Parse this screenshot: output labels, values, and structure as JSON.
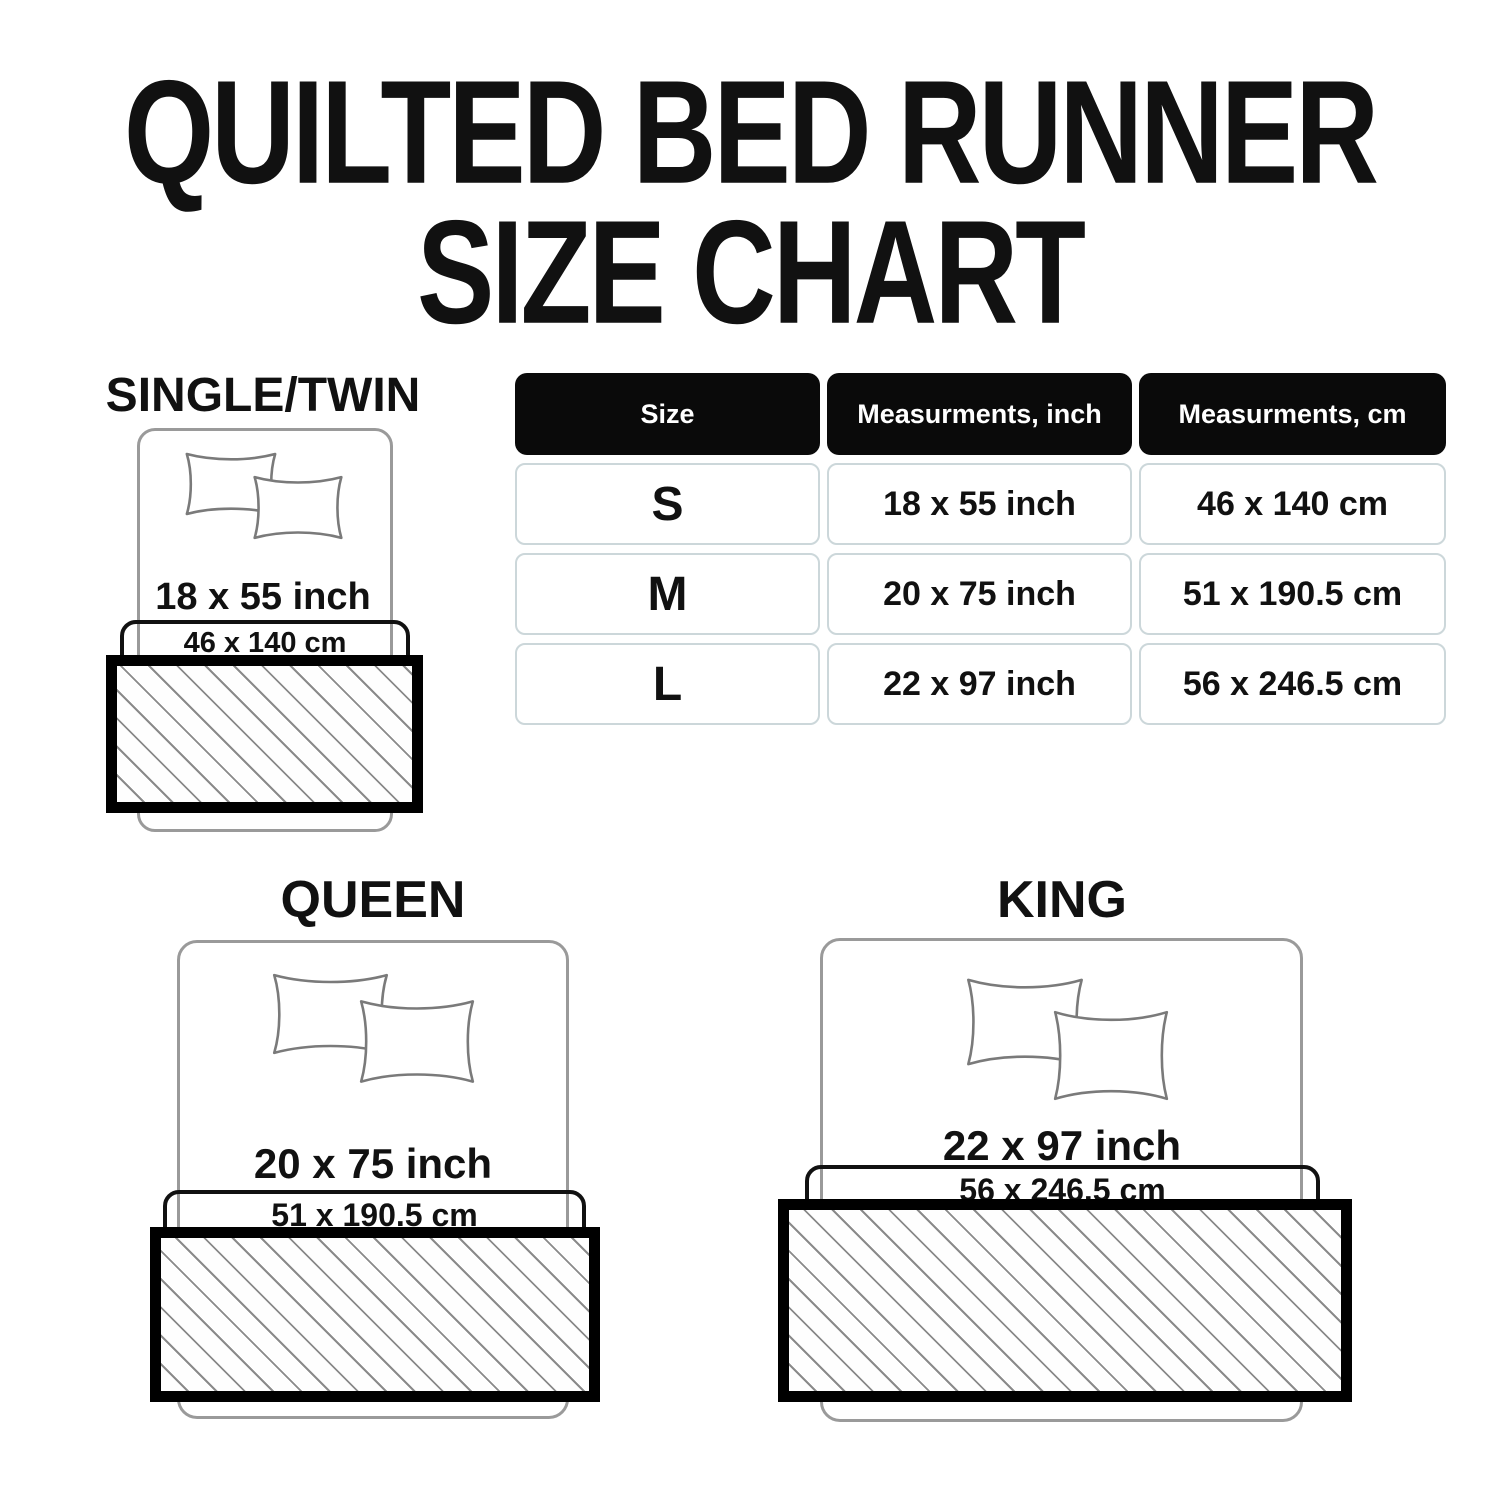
{
  "title": {
    "line1": "QUILTED BED RUNNER",
    "line2": "SIZE CHART"
  },
  "diagrams": [
    {
      "name": "SINGLE/TWIN",
      "inch": "18 x 55 inch",
      "cm": "46 x 140 cm"
    },
    {
      "name": "QUEEN",
      "inch": "20 x 75 inch",
      "cm": "51 x 190.5 cm"
    },
    {
      "name": "KING",
      "inch": "22 x 97 inch",
      "cm": "56 x 246.5 cm"
    }
  ],
  "size_table": {
    "headers": [
      "Size",
      "Measurments, inch",
      "Measurments, cm"
    ],
    "rows": [
      {
        "size": "S",
        "inch": "18 x 55 inch",
        "cm": "46 x 140 cm"
      },
      {
        "size": "M",
        "inch": "20 x 75 inch",
        "cm": "51 x 190.5 cm"
      },
      {
        "size": "L",
        "inch": "22 x 97 inch",
        "cm": "56 x 246.5 cm"
      }
    ]
  },
  "colors": {
    "text": "#111111",
    "table_header_bg": "#0a0a0a",
    "table_header_text": "#ffffff",
    "table_cell_border": "#ccd7da",
    "bed_outline": "#9a9a9a",
    "pillow_outline": "#7a7a7a",
    "runner_border": "#000000",
    "hatch_line": "#8a8a8a",
    "background": "#ffffff"
  }
}
